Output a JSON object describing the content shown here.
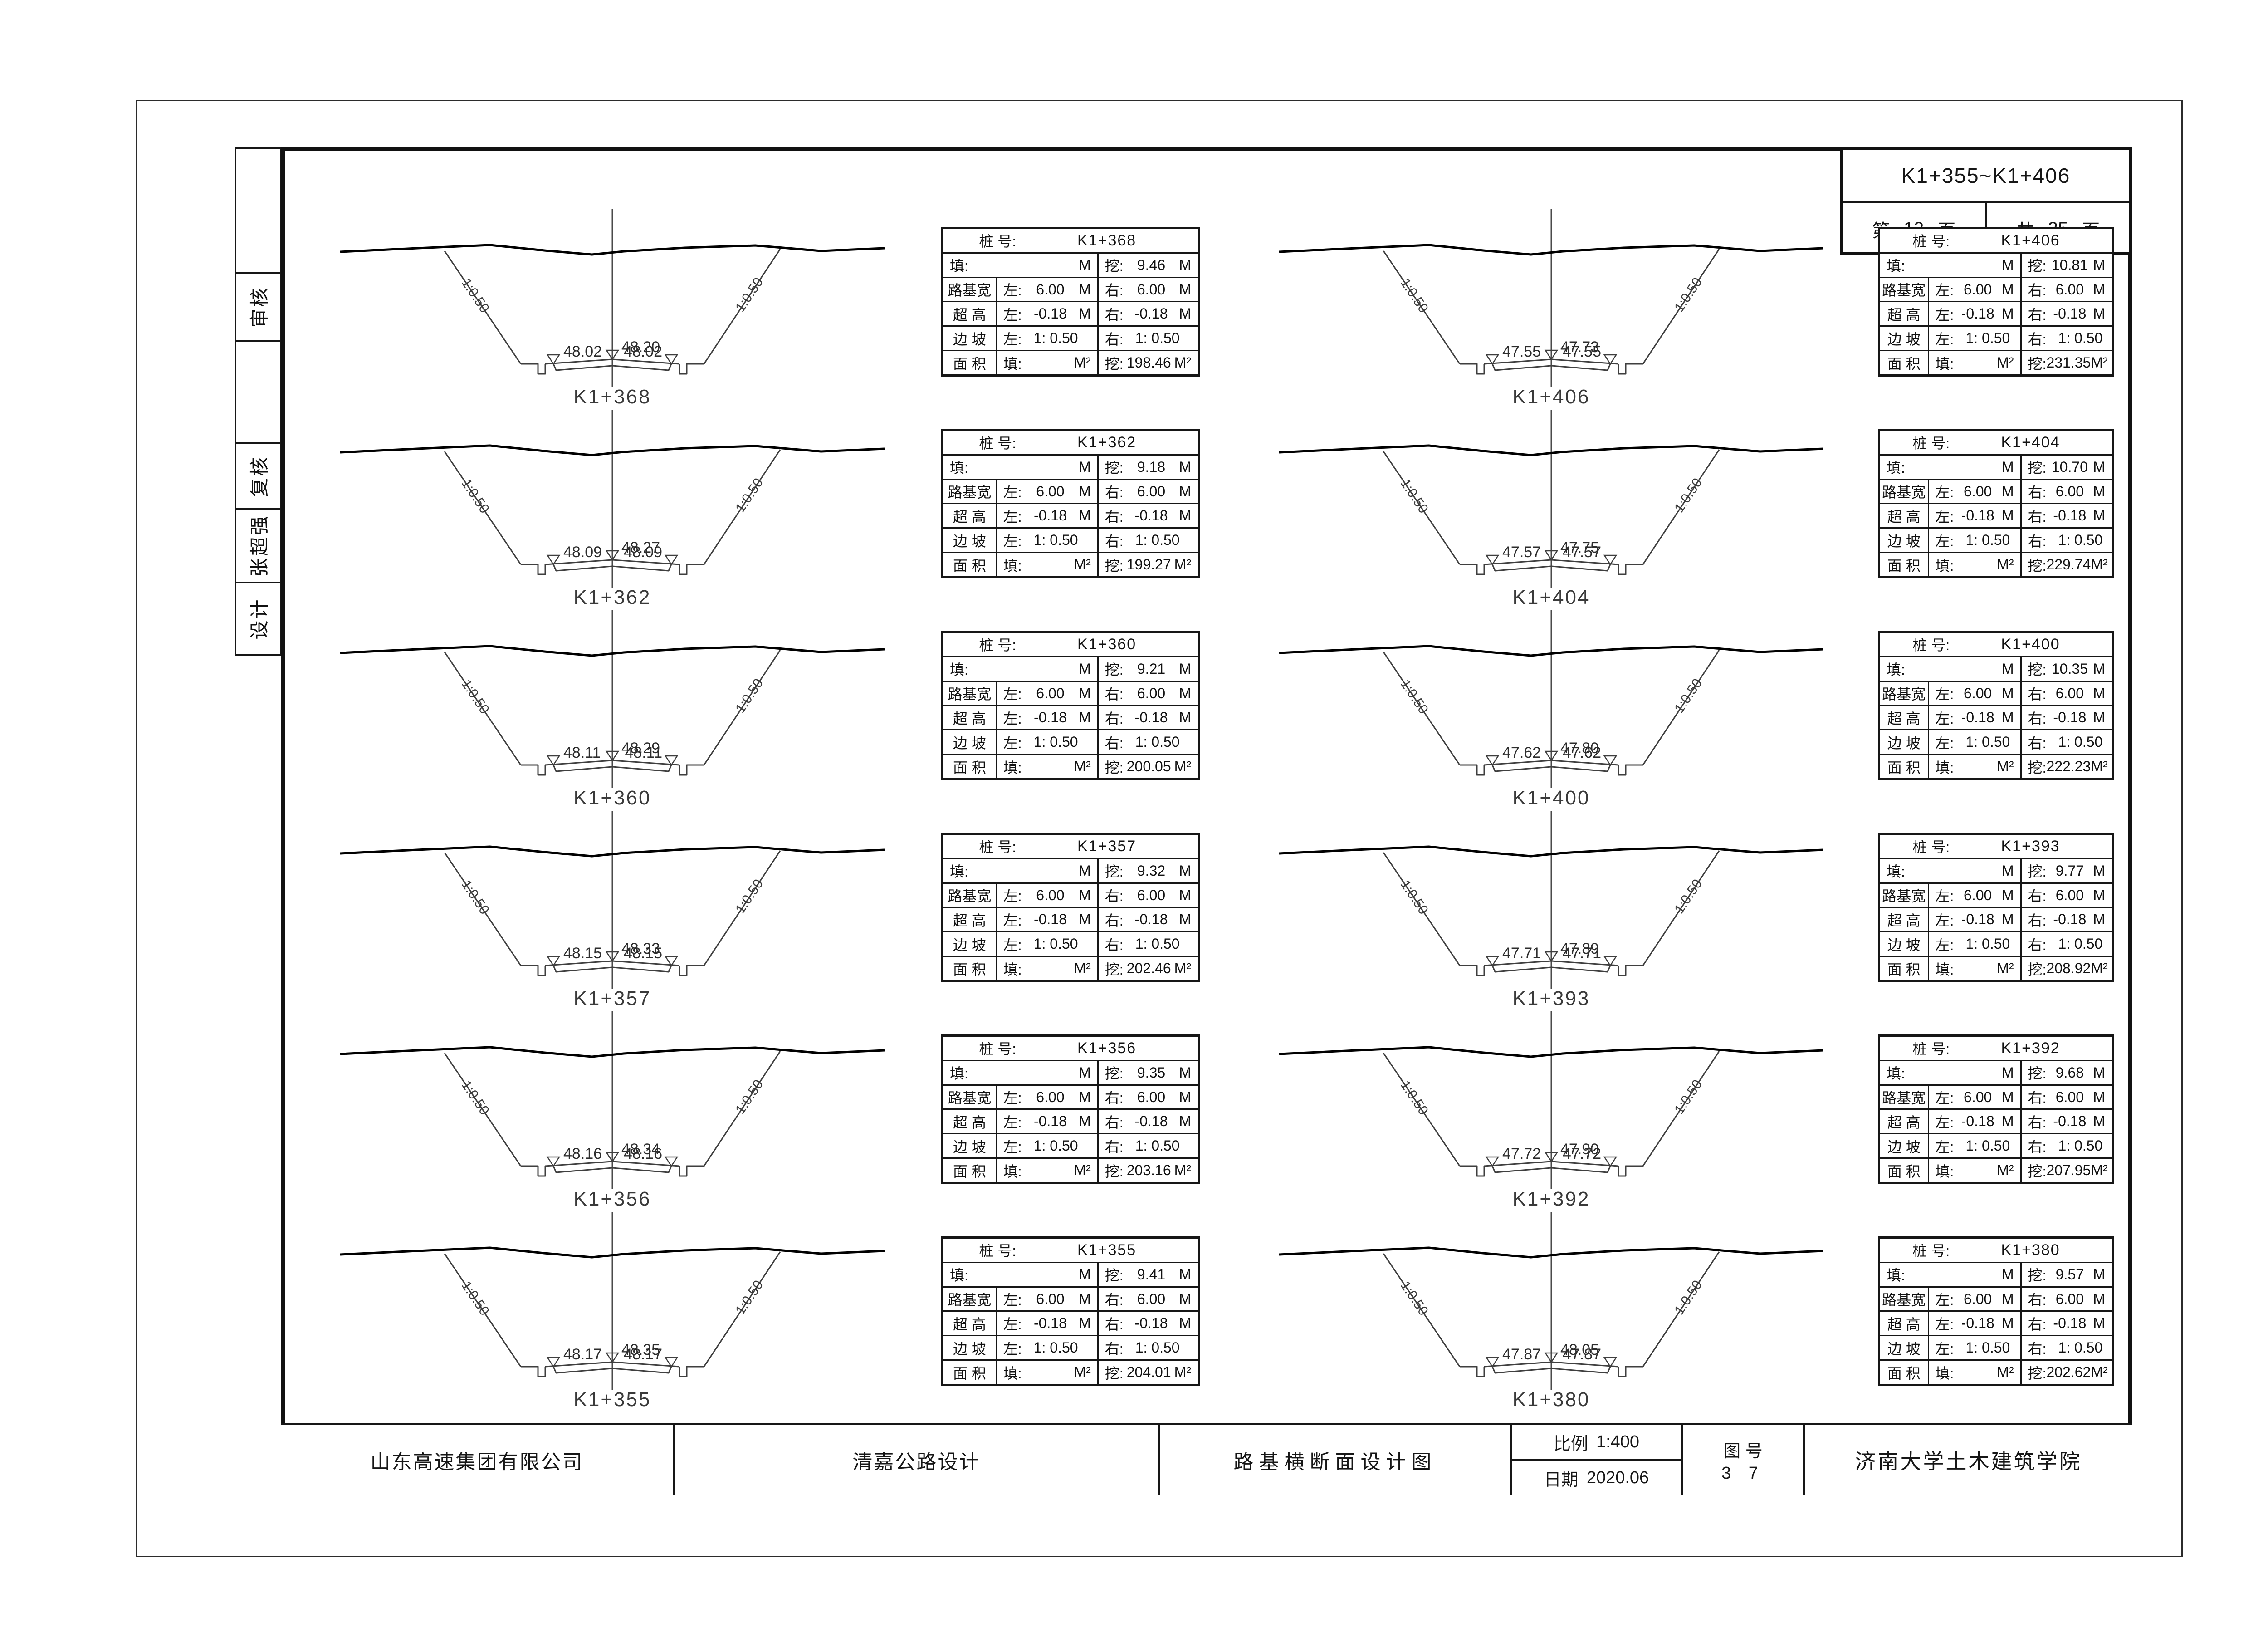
{
  "header": {
    "range": "K1+355~K1+406",
    "page_pre": "第",
    "page_num": "12",
    "page_post": "页",
    "total_pre": "共",
    "total_num": "35",
    "total_post": "页"
  },
  "sidebar": {
    "cells": [
      "",
      "审核",
      "",
      "复核",
      "张超强",
      "设计"
    ]
  },
  "table_labels": {
    "station": "桩  号:",
    "fill": "填:",
    "cut": "挖:",
    "left": "左:",
    "right": "右:",
    "roadbed_width": "路基宽",
    "superelevation": "超  高",
    "side_slope": "边  坡",
    "area": "面  积",
    "unit_m": "M",
    "unit_m2": "M²"
  },
  "left_column": {
    "sections": [
      {
        "station": "K1+368",
        "elev_left": "48.02",
        "elev_center": "48.20",
        "elev_right": "48.02",
        "slope_left": "1:0.50",
        "slope_right": "1:0.50",
        "table": {
          "fill_depth": "",
          "cut_depth": "9.46",
          "roadbed_left": "6.00",
          "roadbed_right": "6.00",
          "super_left": "-0.18",
          "super_right": "-0.18",
          "slope_left": "1: 0.50",
          "slope_right": "1: 0.50",
          "area_fill": "",
          "area_cut": "198.46"
        }
      },
      {
        "station": "K1+362",
        "elev_left": "48.09",
        "elev_center": "48.27",
        "elev_right": "48.09",
        "slope_left": "1:0.50",
        "slope_right": "1:0.50",
        "table": {
          "fill_depth": "",
          "cut_depth": "9.18",
          "roadbed_left": "6.00",
          "roadbed_right": "6.00",
          "super_left": "-0.18",
          "super_right": "-0.18",
          "slope_left": "1: 0.50",
          "slope_right": "1: 0.50",
          "area_fill": "",
          "area_cut": "199.27"
        }
      },
      {
        "station": "K1+360",
        "elev_left": "48.11",
        "elev_center": "48.29",
        "elev_right": "48.11",
        "slope_left": "1:0.50",
        "slope_right": "1:0.50",
        "table": {
          "fill_depth": "",
          "cut_depth": "9.21",
          "roadbed_left": "6.00",
          "roadbed_right": "6.00",
          "super_left": "-0.18",
          "super_right": "-0.18",
          "slope_left": "1: 0.50",
          "slope_right": "1: 0.50",
          "area_fill": "",
          "area_cut": "200.05"
        }
      },
      {
        "station": "K1+357",
        "elev_left": "48.15",
        "elev_center": "48.33",
        "elev_right": "48.15",
        "slope_left": "1:0.50",
        "slope_right": "1:0.50",
        "table": {
          "fill_depth": "",
          "cut_depth": "9.32",
          "roadbed_left": "6.00",
          "roadbed_right": "6.00",
          "super_left": "-0.18",
          "super_right": "-0.18",
          "slope_left": "1: 0.50",
          "slope_right": "1: 0.50",
          "area_fill": "",
          "area_cut": "202.46"
        }
      },
      {
        "station": "K1+356",
        "elev_left": "48.16",
        "elev_center": "48.34",
        "elev_right": "48.16",
        "slope_left": "1:0.50",
        "slope_right": "1:0.50",
        "table": {
          "fill_depth": "",
          "cut_depth": "9.35",
          "roadbed_left": "6.00",
          "roadbed_right": "6.00",
          "super_left": "-0.18",
          "super_right": "-0.18",
          "slope_left": "1: 0.50",
          "slope_right": "1: 0.50",
          "area_fill": "",
          "area_cut": "203.16"
        }
      },
      {
        "station": "K1+355",
        "elev_left": "48.17",
        "elev_center": "48.35",
        "elev_right": "48.17",
        "slope_left": "1:0.50",
        "slope_right": "1:0.50",
        "table": {
          "fill_depth": "",
          "cut_depth": "9.41",
          "roadbed_left": "6.00",
          "roadbed_right": "6.00",
          "super_left": "-0.18",
          "super_right": "-0.18",
          "slope_left": "1: 0.50",
          "slope_right": "1: 0.50",
          "area_fill": "",
          "area_cut": "204.01"
        }
      }
    ]
  },
  "right_column": {
    "sections": [
      {
        "station": "K1+406",
        "elev_left": "47.55",
        "elev_center": "47.73",
        "elev_right": "47.55",
        "slope_left": "1:0.50",
        "slope_right": "1:0.50",
        "table": {
          "fill_depth": "",
          "cut_depth": "10.81",
          "roadbed_left": "6.00",
          "roadbed_right": "6.00",
          "super_left": "-0.18",
          "super_right": "-0.18",
          "slope_left": "1: 0.50",
          "slope_right": "1: 0.50",
          "area_fill": "",
          "area_cut": "231.35"
        }
      },
      {
        "station": "K1+404",
        "elev_left": "47.57",
        "elev_center": "47.75",
        "elev_right": "47.57",
        "slope_left": "1:0.50",
        "slope_right": "1:0.50",
        "table": {
          "fill_depth": "",
          "cut_depth": "10.70",
          "roadbed_left": "6.00",
          "roadbed_right": "6.00",
          "super_left": "-0.18",
          "super_right": "-0.18",
          "slope_left": "1: 0.50",
          "slope_right": "1: 0.50",
          "area_fill": "",
          "area_cut": "229.74"
        }
      },
      {
        "station": "K1+400",
        "elev_left": "47.62",
        "elev_center": "47.80",
        "elev_right": "47.62",
        "slope_left": "1:0.50",
        "slope_right": "1:0.50",
        "table": {
          "fill_depth": "",
          "cut_depth": "10.35",
          "roadbed_left": "6.00",
          "roadbed_right": "6.00",
          "super_left": "-0.18",
          "super_right": "-0.18",
          "slope_left": "1: 0.50",
          "slope_right": "1: 0.50",
          "area_fill": "",
          "area_cut": "222.23"
        }
      },
      {
        "station": "K1+393",
        "elev_left": "47.71",
        "elev_center": "47.89",
        "elev_right": "47.71",
        "slope_left": "1:0.50",
        "slope_right": "1:0.50",
        "table": {
          "fill_depth": "",
          "cut_depth": "9.77",
          "roadbed_left": "6.00",
          "roadbed_right": "6.00",
          "super_left": "-0.18",
          "super_right": "-0.18",
          "slope_left": "1: 0.50",
          "slope_right": "1: 0.50",
          "area_fill": "",
          "area_cut": "208.92"
        }
      },
      {
        "station": "K1+392",
        "elev_left": "47.72",
        "elev_center": "47.90",
        "elev_right": "47.72",
        "slope_left": "1:0.50",
        "slope_right": "1:0.50",
        "table": {
          "fill_depth": "",
          "cut_depth": "9.68",
          "roadbed_left": "6.00",
          "roadbed_right": "6.00",
          "super_left": "-0.18",
          "super_right": "-0.18",
          "slope_left": "1: 0.50",
          "slope_right": "1: 0.50",
          "area_fill": "",
          "area_cut": "207.95"
        }
      },
      {
        "station": "K1+380",
        "elev_left": "47.87",
        "elev_center": "48.05",
        "elev_right": "47.87",
        "slope_left": "1:0.50",
        "slope_right": "1:0.50",
        "table": {
          "fill_depth": "",
          "cut_depth": "9.57",
          "roadbed_left": "6.00",
          "roadbed_right": "6.00",
          "super_left": "-0.18",
          "super_right": "-0.18",
          "slope_left": "1: 0.50",
          "slope_right": "1: 0.50",
          "area_fill": "",
          "area_cut": "202.62"
        }
      }
    ]
  },
  "title_block": {
    "company": "山东高速集团有限公司",
    "project": "清嘉公路设计",
    "drawing_title": "路基横断面设计图",
    "scale_label": "比例",
    "scale_value": "1:400",
    "date_label": "日期",
    "date_value": "2020.06",
    "figure_label": "图 号",
    "figure_value": "3 7",
    "institute": "济南大学土木建筑学院"
  }
}
